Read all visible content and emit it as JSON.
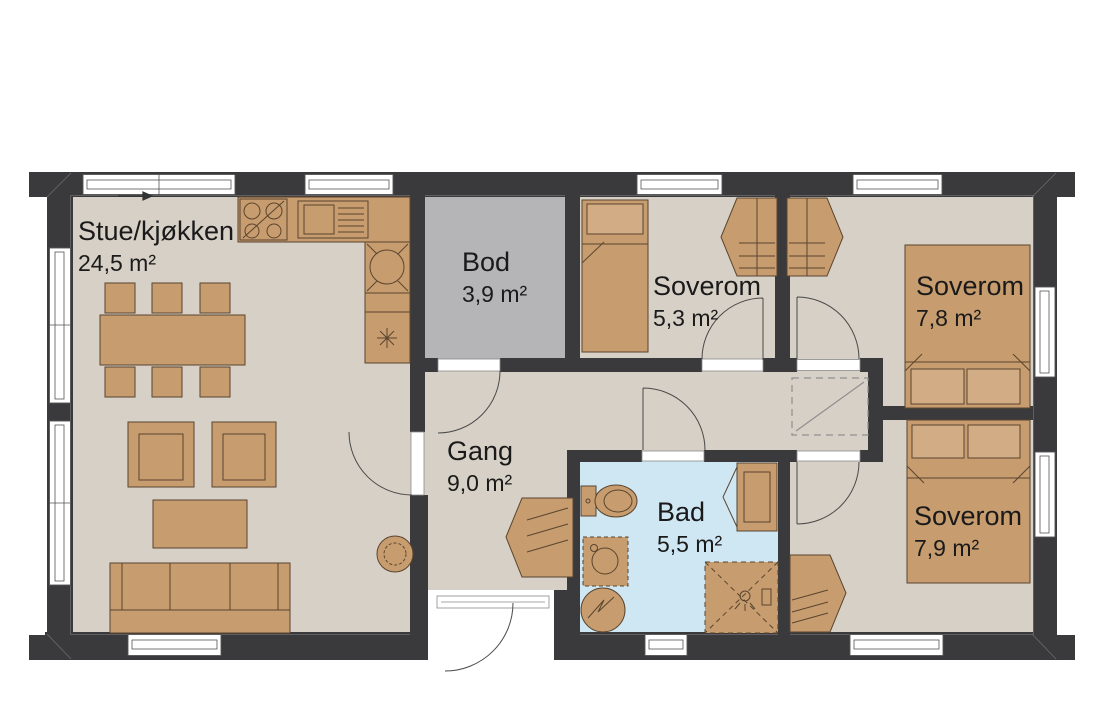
{
  "plan": {
    "rooms": [
      {
        "key": "stue-kjokken",
        "name": "Stue/kjøkken",
        "area": "24,5 m²"
      },
      {
        "key": "bod",
        "name": "Bod",
        "area": "3,9 m²"
      },
      {
        "key": "soverom-1",
        "name": "Soverom",
        "area": "5,3 m²"
      },
      {
        "key": "soverom-2",
        "name": "Soverom",
        "area": "7,8 m²"
      },
      {
        "key": "gang",
        "name": "Gang",
        "area": "9,0 m²"
      },
      {
        "key": "bad",
        "name": "Bad",
        "area": "5,5 m²"
      },
      {
        "key": "soverom-3",
        "name": "Soverom",
        "area": "7,9 m²"
      }
    ],
    "colors": {
      "background": "#ffffff",
      "wall": "#3a3a3c",
      "floor": "#d7d0c6",
      "storage_floor": "#b5b5b7",
      "bath_floor": "#cfe7f3",
      "furniture": "#c79c6e",
      "furniture_light": "#d2ac84",
      "outline": "#5a452f",
      "text": "#1a1a1a"
    }
  }
}
